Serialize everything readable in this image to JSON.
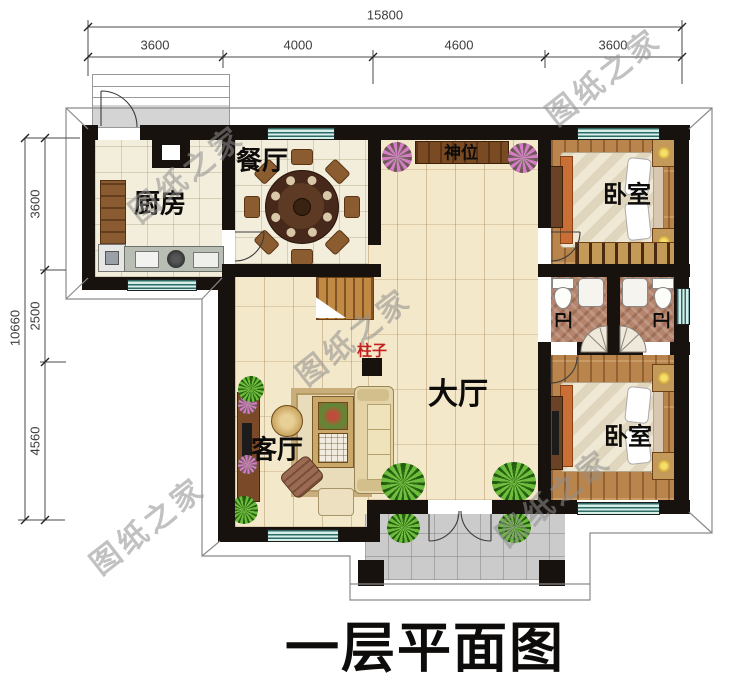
{
  "title": "一层平面图",
  "watermark": {
    "text": "图纸之家"
  },
  "dimensions": {
    "top": {
      "total": "15800",
      "segments": [
        "3600",
        "4000",
        "4600",
        "3600"
      ]
    },
    "left": {
      "total": "10660",
      "segments": [
        "3600",
        "2500",
        "4560"
      ]
    }
  },
  "rooms": {
    "kitchen": {
      "label": "厨房"
    },
    "dining": {
      "label": "餐厅"
    },
    "shrine": {
      "label": "神位"
    },
    "hall": {
      "label": "大厅"
    },
    "living": {
      "label": "客厅"
    },
    "bedroom_top": {
      "label": "卧室"
    },
    "bedroom_bottom": {
      "label": "卧室"
    },
    "bath_left": {
      "label": "卫"
    },
    "bath_right": {
      "label": "卫"
    },
    "pillar": {
      "label": "柱子"
    }
  },
  "colors": {
    "wall": "#17120e",
    "pillar_label_red": "#c41f1f",
    "window_glass": "#d7efe9",
    "floor_tile": "#f3eedb",
    "floor_hall": "#f4e8cb",
    "floor_wood": "#b9854d",
    "floor_bath": "#b5846c",
    "porch": "#cbcbcb",
    "watermark_gray": "#8f8f8f"
  }
}
